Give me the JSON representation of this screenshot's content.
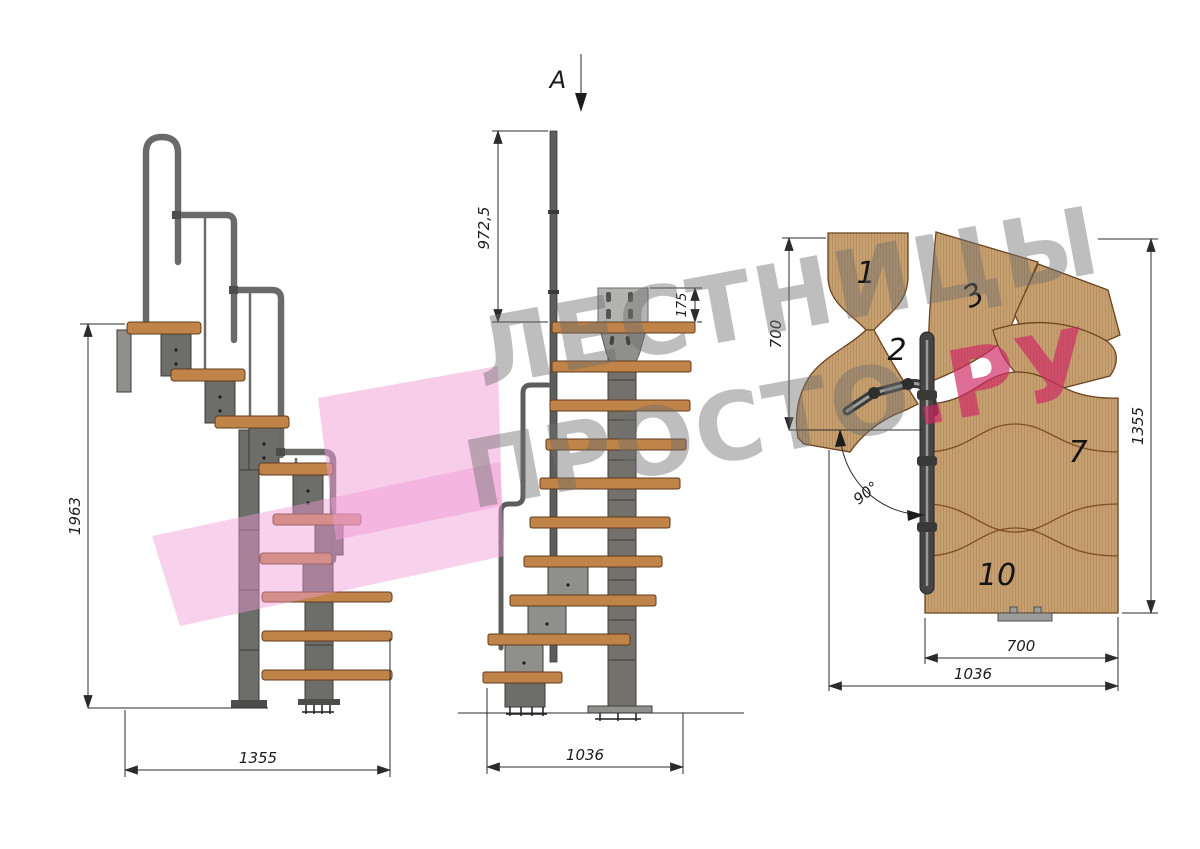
{
  "drawing": {
    "section_marker": "A",
    "side_view": {
      "total_height": "1963",
      "total_length": "1355"
    },
    "front_view": {
      "handrail_post_height": "972,5",
      "mount_plate_height": "175",
      "total_width": "1036"
    },
    "plan_view": {
      "tread_numbers": [
        "1",
        "2",
        "3",
        "7",
        "10"
      ],
      "upper_flight_depth": "700",
      "total_depth": "1355",
      "lower_flight_width": "700",
      "total_width": "1036",
      "turn_angle": "90°"
    }
  },
  "watermark": {
    "line1": "ЛЕСТНИЦЫ",
    "line2_main": "ПРОСТО",
    "line2_accent": ".РУ"
  },
  "colors": {
    "wood_side": "#c08449",
    "wood_plan": "#c7a072",
    "wood_edge": "#6b431f",
    "metal": "#6d6d69",
    "metal_dark": "#3b3b39",
    "dim_line": "#2b2b2b",
    "watermark_gray": "#6e6e6e",
    "watermark_pink": "#ce2864",
    "logo_pink": "#f09bd6"
  }
}
